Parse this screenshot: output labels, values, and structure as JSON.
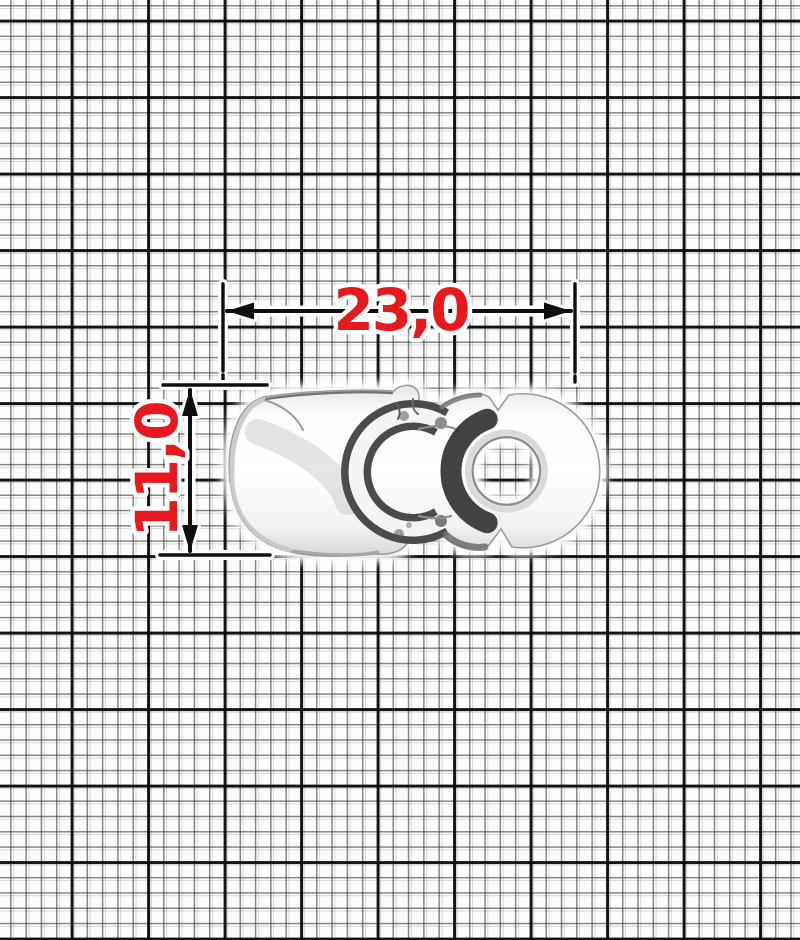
{
  "subject": {
    "description": "polished nickel hook clasp photographed on millimeter graph paper",
    "metal_color": "#f4f4f4"
  },
  "dimensions": {
    "width_label": "23,0",
    "height_label": "11,0"
  },
  "style": {
    "label_color": "#e8191e",
    "dimension_line_color": "#0f0f0f",
    "paper_color": "#fcfcfc",
    "grid_minor_color": "#373737",
    "grid_major_color": "#080808"
  }
}
